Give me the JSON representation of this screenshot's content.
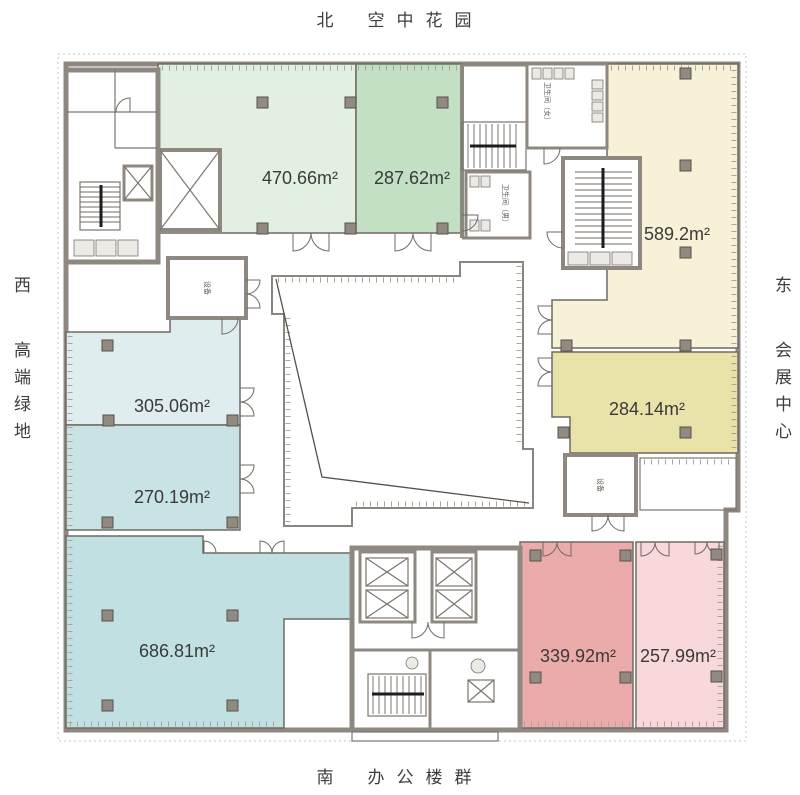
{
  "orientation": {
    "north": {
      "dir": "北",
      "desc": "空中花园"
    },
    "south": {
      "dir": "南",
      "desc": "办公楼群"
    },
    "west": {
      "dir": "西",
      "desc": "高端绿地"
    },
    "east": {
      "dir": "东",
      "desc": "会展中心"
    }
  },
  "rooms": [
    {
      "id": "room-470",
      "area": "470.66m²",
      "color": "#e2f0e2"
    },
    {
      "id": "room-287",
      "area": "287.62m²",
      "color": "#c3e0c5"
    },
    {
      "id": "room-589",
      "area": "589.2m²",
      "color": "#f7f1d8"
    },
    {
      "id": "room-284",
      "area": "284.14m²",
      "color": "#e9e3aa"
    },
    {
      "id": "room-305",
      "area": "305.06m²",
      "color": "#dfedee"
    },
    {
      "id": "room-270",
      "area": "270.19m²",
      "color": "#c9e2e4"
    },
    {
      "id": "room-686",
      "area": "686.81m²",
      "color": "#c1e0e1"
    },
    {
      "id": "room-339",
      "area": "339.92m²",
      "color": "#ecabab"
    },
    {
      "id": "room-257",
      "area": "257.99m²",
      "color": "#f8d8da"
    }
  ],
  "utility_labels": {
    "equipment": "设备",
    "wc_female": "卫生间（女）",
    "wc_male": "卫生间（男）"
  },
  "palette": {
    "wall": "#8f8880",
    "line": "#7b756e",
    "column": "#908a81",
    "area_text": "#3a3a3a",
    "small_text": "#5d564c"
  }
}
